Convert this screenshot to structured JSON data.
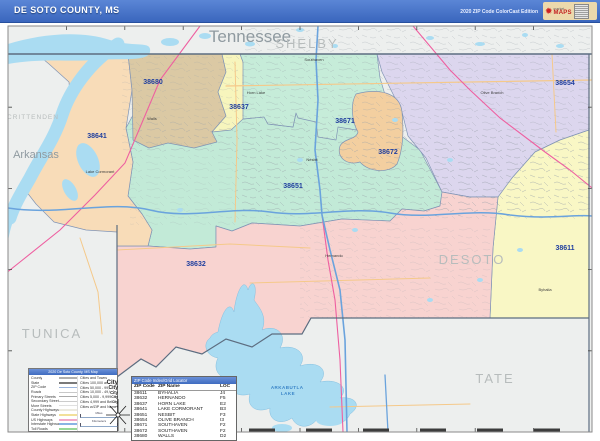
{
  "header": {
    "title": "DE SOTO COUNTY, MS",
    "edition": "2020 ZIP Code ColorCast Edition",
    "logo": {
      "line1": "market",
      "line2": "MAPS",
      "burst": "✹"
    }
  },
  "map": {
    "states": [
      "Tennessee",
      "Arkansas"
    ],
    "counties": [
      "SHELBY",
      "CRITTENDEN",
      "TUNICA",
      "TATE",
      "DESOTO"
    ],
    "lake_label": {
      "line1": "ARKABUTLA",
      "line2": "LAKE"
    },
    "cities": [
      "Walls",
      "Horn Lake",
      "Southaven",
      "Olive Branch",
      "Nesbit",
      "Hernando",
      "Lake Cormorant",
      "Byhalia"
    ]
  },
  "zips": [
    {
      "code": "38611",
      "name": "BYHALIA",
      "loc": "J4",
      "color": "#f9f7c5"
    },
    {
      "code": "38632",
      "name": "HERNANDO",
      "loc": "F5",
      "color": "#f8d3d0"
    },
    {
      "code": "38637",
      "name": "HORN LAKE",
      "loc": "E2",
      "color": "#f7f5bd"
    },
    {
      "code": "38641",
      "name": "LAKE CORMORANT",
      "loc": "B3",
      "color": "#f8dcb8"
    },
    {
      "code": "38651",
      "name": "NESBIT",
      "loc": "F3",
      "color": "#c2ead7"
    },
    {
      "code": "38654",
      "name": "OLIVE BRANCH",
      "loc": "I3",
      "color": "#dcd6ee"
    },
    {
      "code": "38671",
      "name": "SOUTHAVEN",
      "loc": "F2",
      "color": "#c6ecd9"
    },
    {
      "code": "38672",
      "name": "SOUTHAVEN",
      "loc": "F2",
      "color": "#f3cfa0"
    },
    {
      "code": "38680",
      "name": "WALLS",
      "loc": "D2",
      "color": "#dbc9a4"
    }
  ],
  "zip_table": {
    "title": "ZIP Code Index/Grid Locator",
    "headers": [
      "ZIP Code",
      "ZIP Name",
      "LOC"
    ]
  },
  "legend": {
    "title": "2020 De Soto County, MS Map",
    "line_items": [
      {
        "label": "County"
      },
      {
        "label": "State"
      },
      {
        "label": "ZIP Code"
      },
      {
        "label": "Roads"
      },
      {
        "label": "Primary Streets"
      },
      {
        "label": "Secondary Streets"
      },
      {
        "label": "More Streets"
      },
      {
        "label": "County Highways"
      },
      {
        "label": "State Highways"
      },
      {
        "label": "US Highways"
      },
      {
        "label": "Interstate Highways"
      },
      {
        "label": "Toll Roads"
      }
    ],
    "cities_header": "Cities and Towns",
    "city_items": [
      {
        "label": "Cities 100,000 and Above",
        "sample": "City"
      },
      {
        "label": "Cities 50,000 - 99,999",
        "sample": "City"
      },
      {
        "label": "Cities 10,000 - 49,999",
        "sample": "City"
      },
      {
        "label": "Cities 5,000 - 9,999",
        "sample": "City"
      },
      {
        "label": "Cities 4,999 and Below",
        "sample": "City"
      },
      {
        "label": "Cities w/ZIP and Name",
        "sample": "+"
      }
    ],
    "scales": [
      {
        "label": "Miles"
      },
      {
        "label": "Kilometers"
      }
    ]
  },
  "colors": {
    "title_bar": "#3f6fc6",
    "outside_area": "#edefee",
    "water": "#aadcf2",
    "zip_label": "#1f3e9e",
    "county_label": "#b7bcbc",
    "state_line": "#5d6d80",
    "zip_boundary": "#8094b5",
    "interstate": "#6aa3dd",
    "us_highway": "#f5c98a",
    "railroad": "#ee5fa0"
  }
}
